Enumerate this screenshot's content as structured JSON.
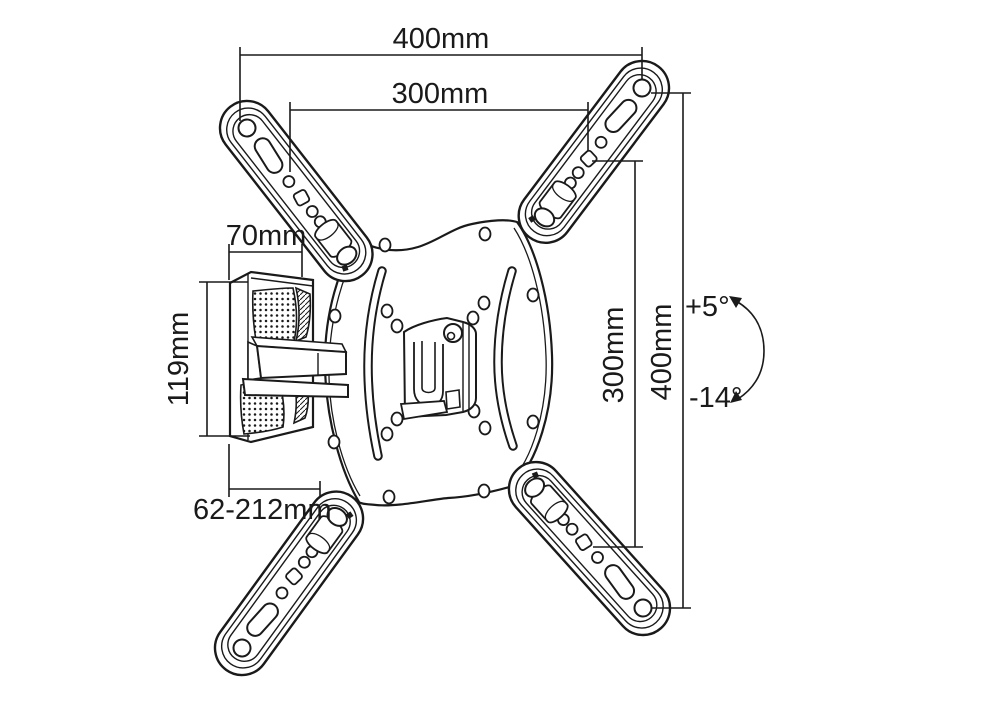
{
  "drawing": {
    "name": "Articulating TV wall mount bracket - dimensioned technical line drawing",
    "background": "#ffffff",
    "line_color": "#1a1a1a"
  },
  "dimensions": {
    "top_width_outer": "400mm",
    "top_width_inner": "300mm",
    "left_depth": "70mm",
    "left_height": "119mm",
    "extension_range": "62-212mm",
    "right_height_inner": "300mm",
    "right_height_outer": "400mm",
    "tilt_up": "+5°",
    "tilt_down": "-14°"
  }
}
